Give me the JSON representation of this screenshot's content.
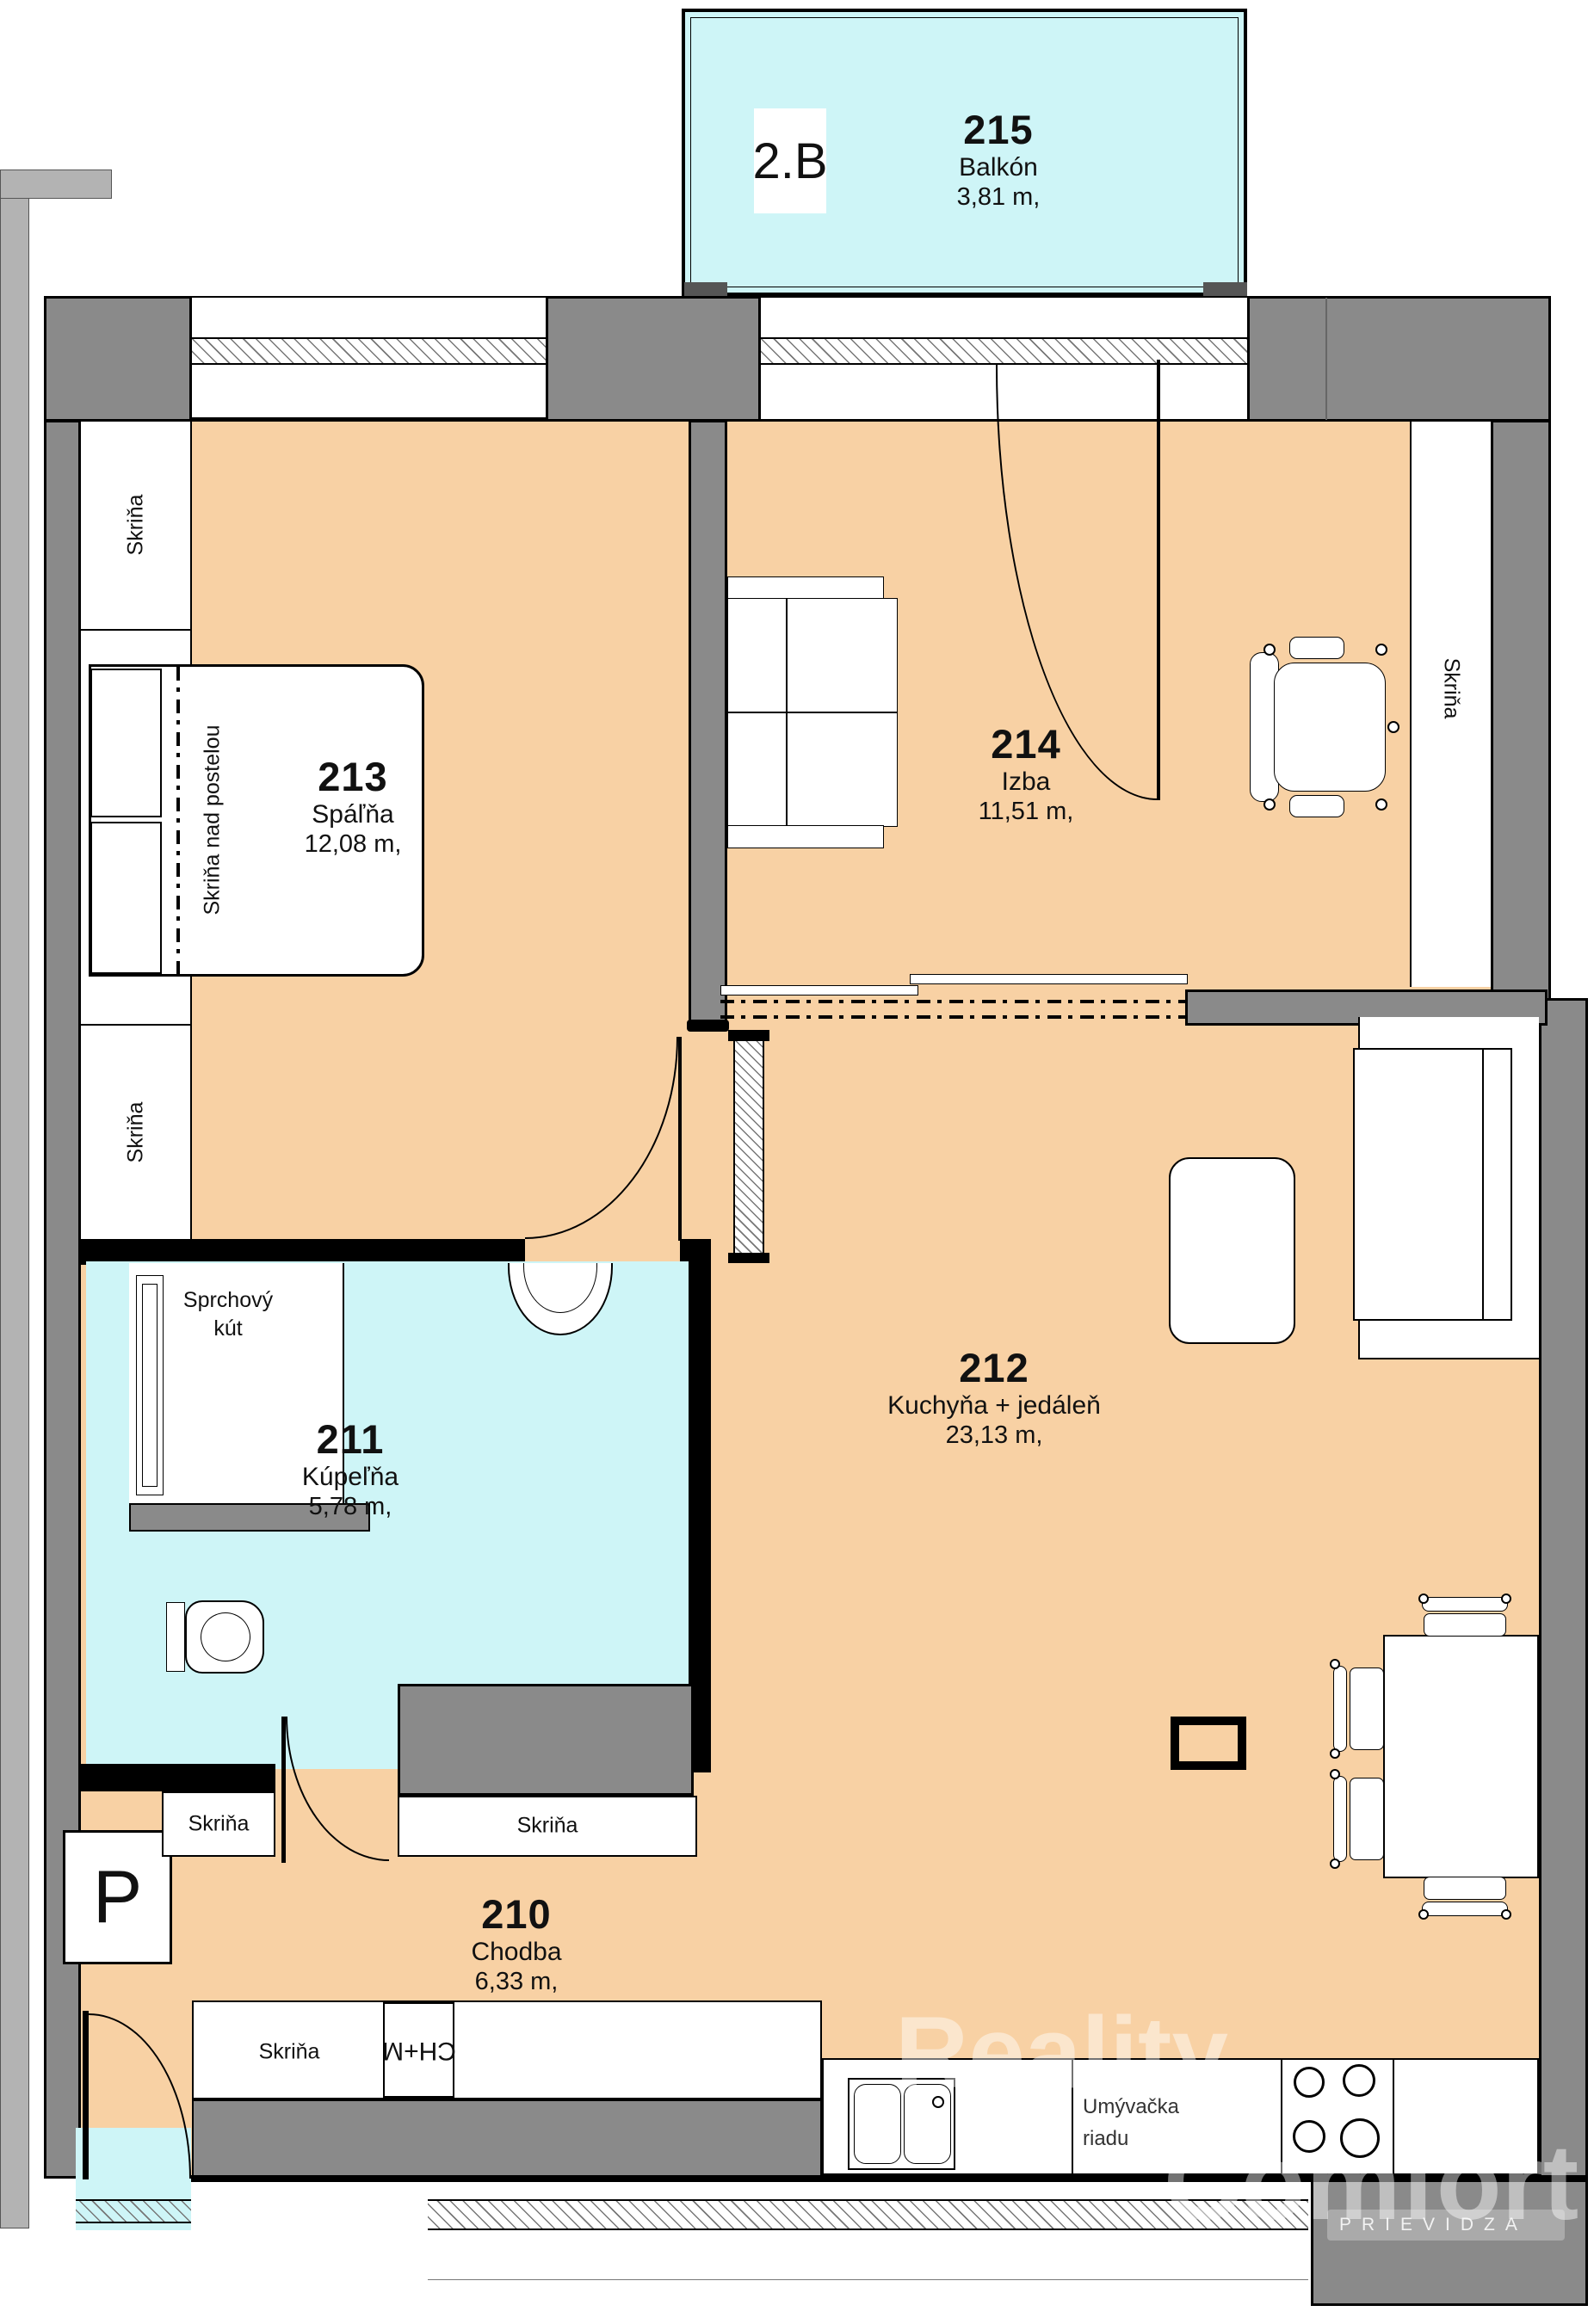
{
  "unit": {
    "label": "2.B"
  },
  "rooms": {
    "balkon": {
      "number": "215",
      "name": "Balkón",
      "area": "3,81 m,"
    },
    "spalna": {
      "number": "213",
      "name": "Spáľňa",
      "area": "12,08 m,"
    },
    "izba": {
      "number": "214",
      "name": "Izba",
      "area": "11,51 m,"
    },
    "kupelna": {
      "number": "211",
      "name": "Kúpeľňa",
      "area": "5,78 m,"
    },
    "kuchyna": {
      "number": "212",
      "name": "Kuchyňa + jedáleň",
      "area": "23,13 m,"
    },
    "chodba": {
      "number": "210",
      "name": "Chodba",
      "area": "6,33 m,"
    }
  },
  "labels": {
    "wardrobe": "Skriňa",
    "wardrobe_over_bed": "Skriňa nad postelou",
    "shower_line1": "Sprchový",
    "shower_line2": "kút",
    "dishwasher_line1": "Umývačka",
    "dishwasher_line2": "riadu",
    "fridge_freezer": "CH+M",
    "washing_machine": "P"
  },
  "watermark": {
    "word1": "Reality",
    "word2": "Comfort",
    "city": "PRIEVIDZA"
  },
  "colors": {
    "floor": "#F8D1A4",
    "wet_floor": "#CEF5F7",
    "wall": "#8A8A8A",
    "outer_wall": "#B3B3B3",
    "line": "#000000"
  }
}
